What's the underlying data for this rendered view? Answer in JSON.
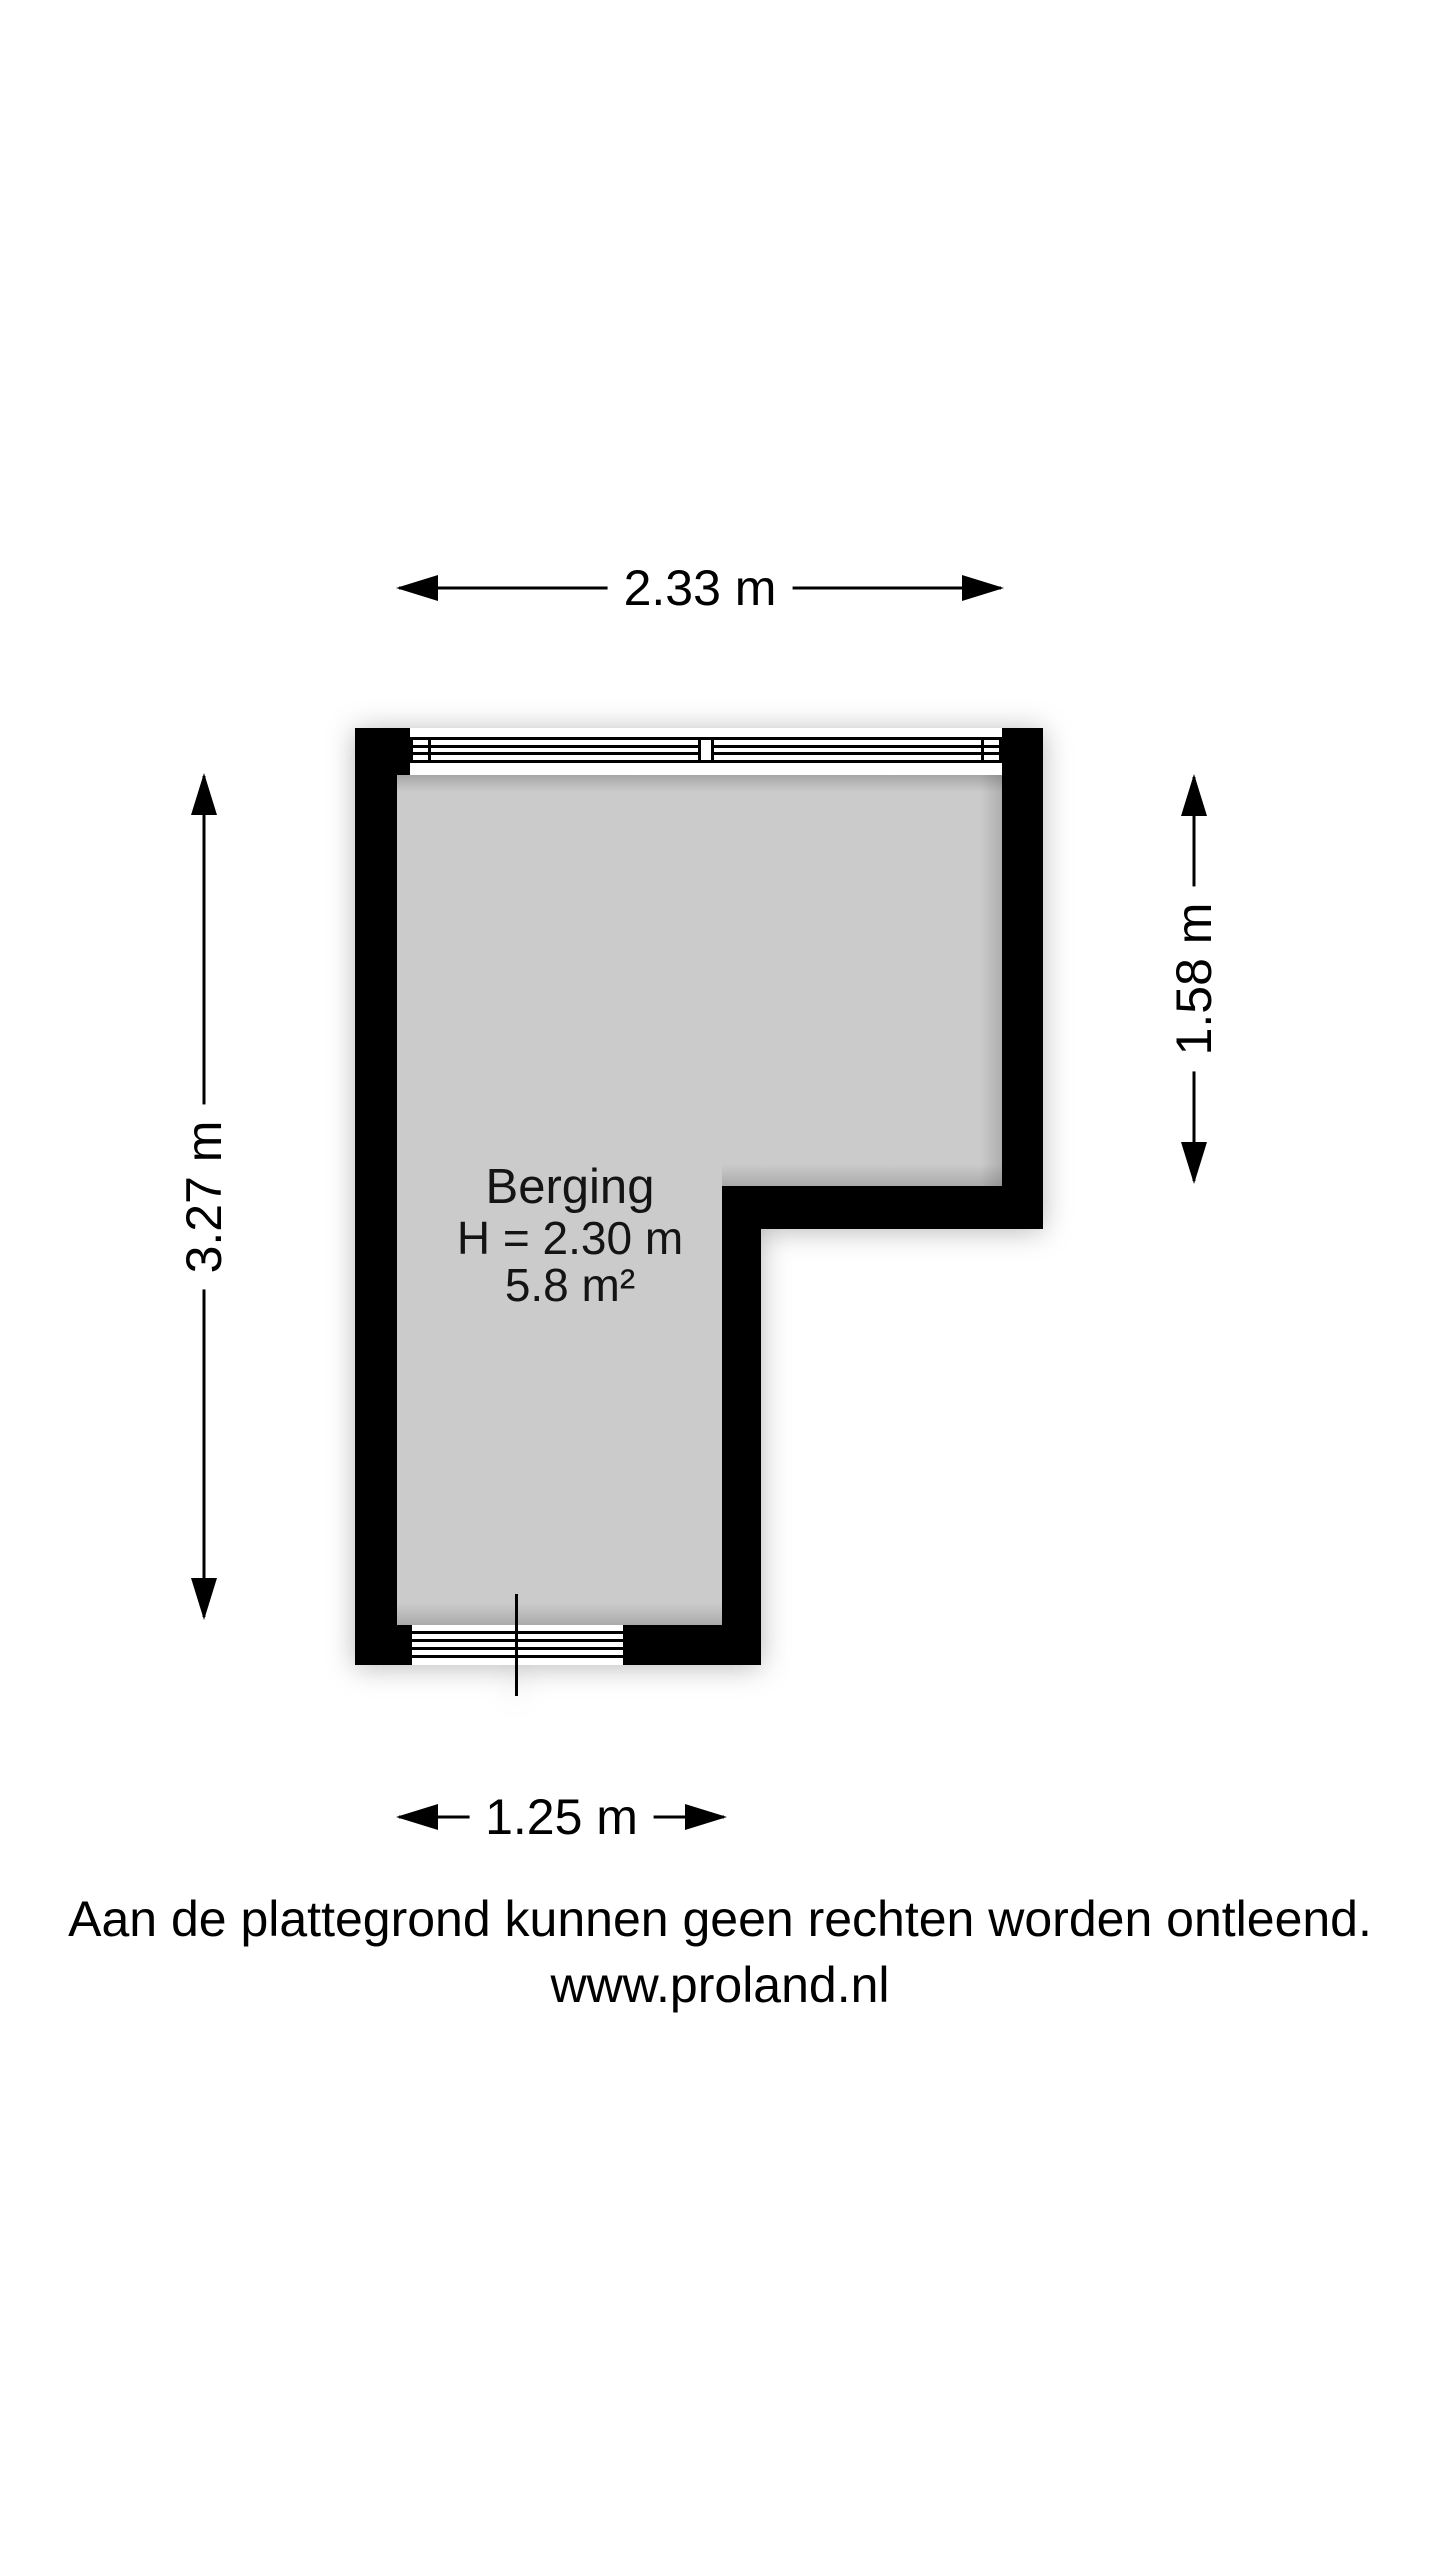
{
  "floorplan": {
    "room": {
      "name": "Berging",
      "ceiling_height": "H = 2.30 m",
      "area": "5.8 m²"
    },
    "dimensions": {
      "top": "2.33 m",
      "left": "3.27 m",
      "right": "1.58 m",
      "bottom": "1.25 m"
    },
    "colors": {
      "wall": "#000000",
      "floor": "#cbcbcb",
      "background": "#ffffff",
      "text": "#141414"
    }
  },
  "footer": {
    "disclaimer": "Aan de plattegrond kunnen geen rechten worden ontleend.",
    "website": "www.proland.nl"
  }
}
